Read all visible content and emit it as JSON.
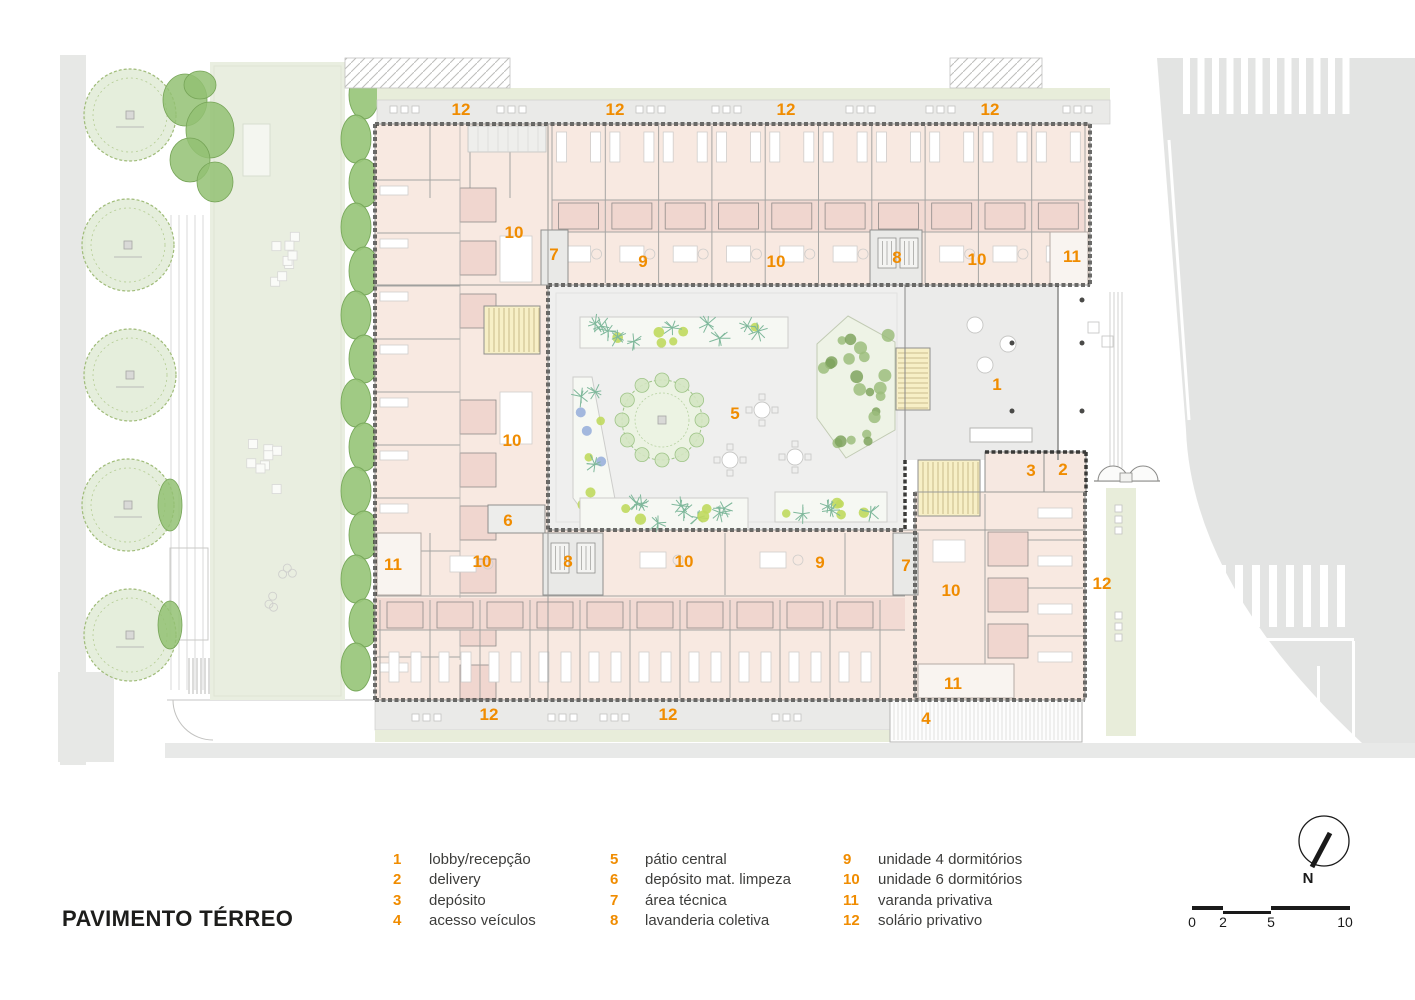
{
  "title": "PAVIMENTO TÉRREO",
  "north_label": "N",
  "colors": {
    "accent": "#F08C00",
    "legend_text": "#3D3D3B",
    "title_text": "#1D1D1B"
  },
  "plan_labels": [
    {
      "text": "12",
      "x": 461,
      "y": 110
    },
    {
      "text": "12",
      "x": 615,
      "y": 110
    },
    {
      "text": "12",
      "x": 786,
      "y": 110
    },
    {
      "text": "12",
      "x": 990,
      "y": 110
    },
    {
      "text": "10",
      "x": 514,
      "y": 233
    },
    {
      "text": "7",
      "x": 554,
      "y": 255
    },
    {
      "text": "9",
      "x": 643,
      "y": 262
    },
    {
      "text": "10",
      "x": 776,
      "y": 262
    },
    {
      "text": "8",
      "x": 897,
      "y": 258
    },
    {
      "text": "10",
      "x": 977,
      "y": 260
    },
    {
      "text": "11",
      "x": 1072,
      "y": 257
    },
    {
      "text": "1",
      "x": 997,
      "y": 385
    },
    {
      "text": "5",
      "x": 735,
      "y": 414
    },
    {
      "text": "3",
      "x": 1031,
      "y": 471
    },
    {
      "text": "2",
      "x": 1063,
      "y": 470
    },
    {
      "text": "10",
      "x": 512,
      "y": 441
    },
    {
      "text": "6",
      "x": 508,
      "y": 521
    },
    {
      "text": "11",
      "x": 393,
      "y": 565
    },
    {
      "text": "10",
      "x": 482,
      "y": 562
    },
    {
      "text": "8",
      "x": 568,
      "y": 562
    },
    {
      "text": "10",
      "x": 684,
      "y": 562
    },
    {
      "text": "9",
      "x": 820,
      "y": 563
    },
    {
      "text": "7",
      "x": 906,
      "y": 566
    },
    {
      "text": "10",
      "x": 951,
      "y": 591
    },
    {
      "text": "12",
      "x": 1102,
      "y": 584
    },
    {
      "text": "11",
      "x": 953,
      "y": 684
    },
    {
      "text": "12",
      "x": 489,
      "y": 715
    },
    {
      "text": "12",
      "x": 668,
      "y": 715
    },
    {
      "text": "4",
      "x": 926,
      "y": 719
    }
  ],
  "legend": {
    "columns": [
      {
        "items": [
          {
            "num": "1",
            "label": "lobby/recepção"
          },
          {
            "num": "2",
            "label": "delivery"
          },
          {
            "num": "3",
            "label": "depósito"
          },
          {
            "num": "4",
            "label": "acesso veículos"
          }
        ]
      },
      {
        "items": [
          {
            "num": "5",
            "label": "pátio central"
          },
          {
            "num": "6",
            "label": "depósito mat. limpeza"
          },
          {
            "num": "7",
            "label": "área técnica"
          },
          {
            "num": "8",
            "label": "lavanderia coletiva"
          }
        ]
      },
      {
        "items": [
          {
            "num": "9",
            "label": "unidade 4 dormitórios"
          },
          {
            "num": "10",
            "label": "unidade 6 dormitórios"
          },
          {
            "num": "11",
            "label": "varanda privativa"
          },
          {
            "num": "12",
            "label": "solário privativo"
          }
        ]
      }
    ]
  },
  "scale_bar": {
    "tick_labels": [
      "0",
      "2",
      "5",
      "10"
    ]
  }
}
